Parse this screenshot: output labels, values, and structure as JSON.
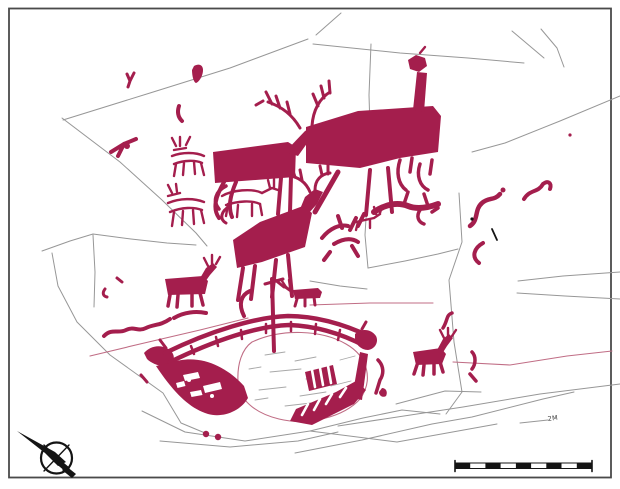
{
  "meta": {
    "description": "Archaeological tracing of a rock carving panel: solid red elk figures, outlined deer, a large ship with elk-head prow and stern, cup marks, natural cracks (grey) and fissures (pink), north arrow and scale bar",
    "canvas": {
      "width": 620,
      "height": 489
    }
  },
  "palette": {
    "figure_red": "#a41e4d",
    "crack_gray": "#979797",
    "fissure_pink": "#c06d85",
    "patch_gray": "#a8a8a8",
    "ink_black": "#141414",
    "border_gray": "#4a4a4a",
    "background": "#ffffff"
  },
  "annotations": {
    "crack_label": "2M"
  },
  "map_elements": {
    "north_arrow": {
      "icon": "north-arrow-icon",
      "pointing": "upper-left"
    },
    "scale_bar": {
      "segments": 9,
      "style": "alternating black and white",
      "position": "bottom-right"
    }
  },
  "motifs": [
    "large solid elk (centre-left)",
    "large solid elk with long neck (upper right)",
    "antlered elk (centre)",
    "pair of outlined deer (upper left)",
    "small solid elk (left)",
    "small solid elk (right of ship)",
    "antler fragment cluster",
    "ship with elk-head prow and stern, mast and crew strokes",
    "two cup marks",
    "wavy line fragments",
    "scattered pecked fragments"
  ]
}
